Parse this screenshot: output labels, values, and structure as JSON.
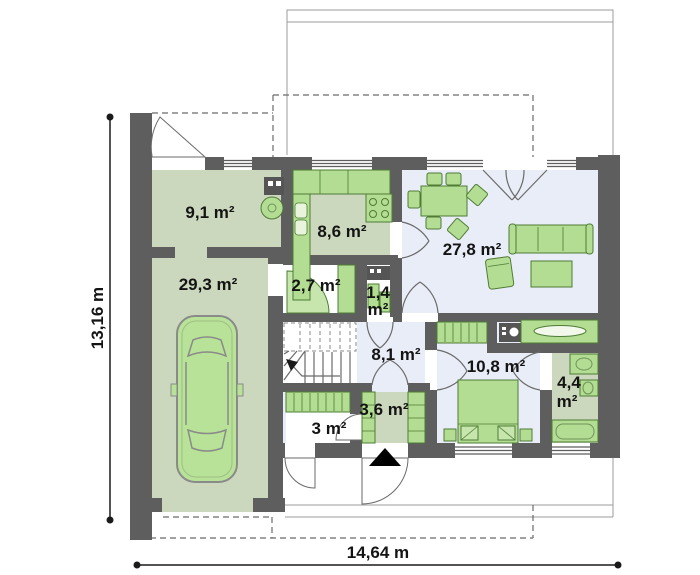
{
  "plan": {
    "type": "house-floor-plan",
    "rooms": [
      {
        "name": "utility-room",
        "area": "9,1 m²"
      },
      {
        "name": "garage",
        "area": "29,3 m²"
      },
      {
        "name": "kitchen",
        "area": "8,6 m²"
      },
      {
        "name": "hall",
        "area": "2,7 m²"
      },
      {
        "name": "wc",
        "area_value": "1,4",
        "area_unit": "m²"
      },
      {
        "name": "living-room",
        "area": "27,8 m²"
      },
      {
        "name": "hallway",
        "area": "8,1 m²"
      },
      {
        "name": "bedroom",
        "area": "10,8 m²"
      },
      {
        "name": "closet",
        "area": "3 m²"
      },
      {
        "name": "wardrobe-room",
        "area": "3,6 m²"
      },
      {
        "name": "bathroom",
        "area_value": "4,4",
        "area_unit": "m²"
      }
    ],
    "dimensions": {
      "height_label": "13,16 m",
      "width_label": "14,64 m"
    },
    "icons": {
      "entrance_marker": "filled-up-triangle",
      "car": "top-view-car",
      "stove": "four-burner-circles",
      "washer": "dark-box-with-round-door"
    },
    "colors": {
      "wall": "#5e5e5e",
      "floor_sage": "#ccd8be",
      "floor_blue": "#e9edf7",
      "furniture_green": "#b3dd92",
      "furniture_border": "#4e7c35",
      "label_text": "#141414",
      "thin_outline": "#9b9b9b"
    }
  }
}
